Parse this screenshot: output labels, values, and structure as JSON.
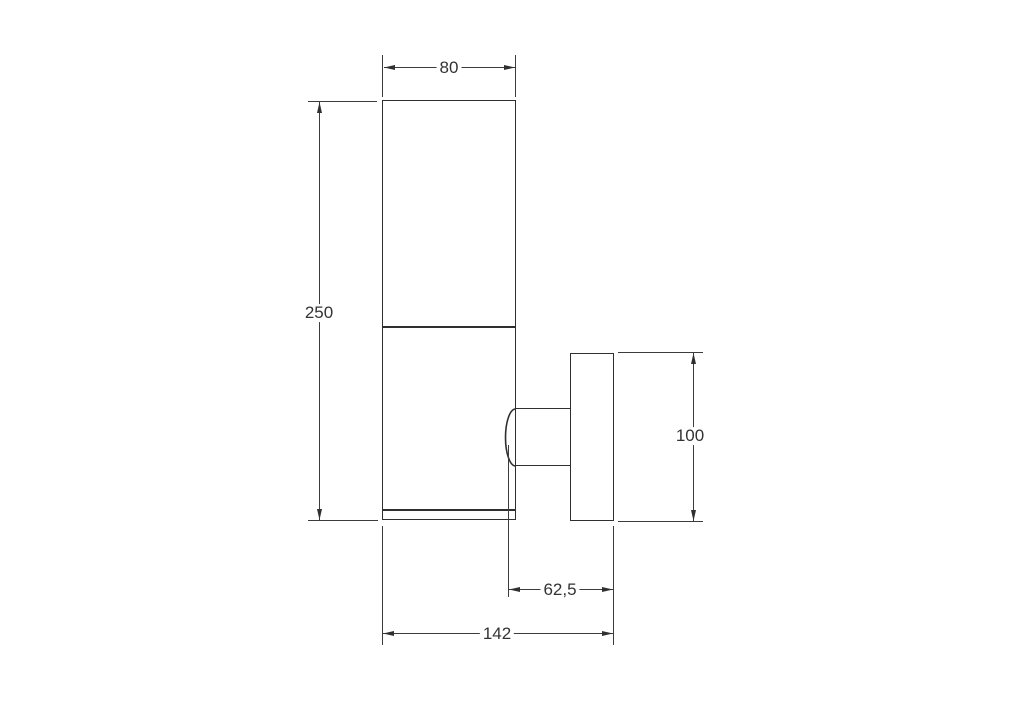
{
  "canvas": {
    "background_color": "#ffffff",
    "object_line_color": "#2f2f2f",
    "dimension_line_color": "#3c3c3c",
    "text_color": "#333333"
  },
  "dimensions": {
    "top_width": "80",
    "left_height": "250",
    "right_height": "100",
    "bracket_depth": "62,5",
    "overall_depth": "142"
  }
}
